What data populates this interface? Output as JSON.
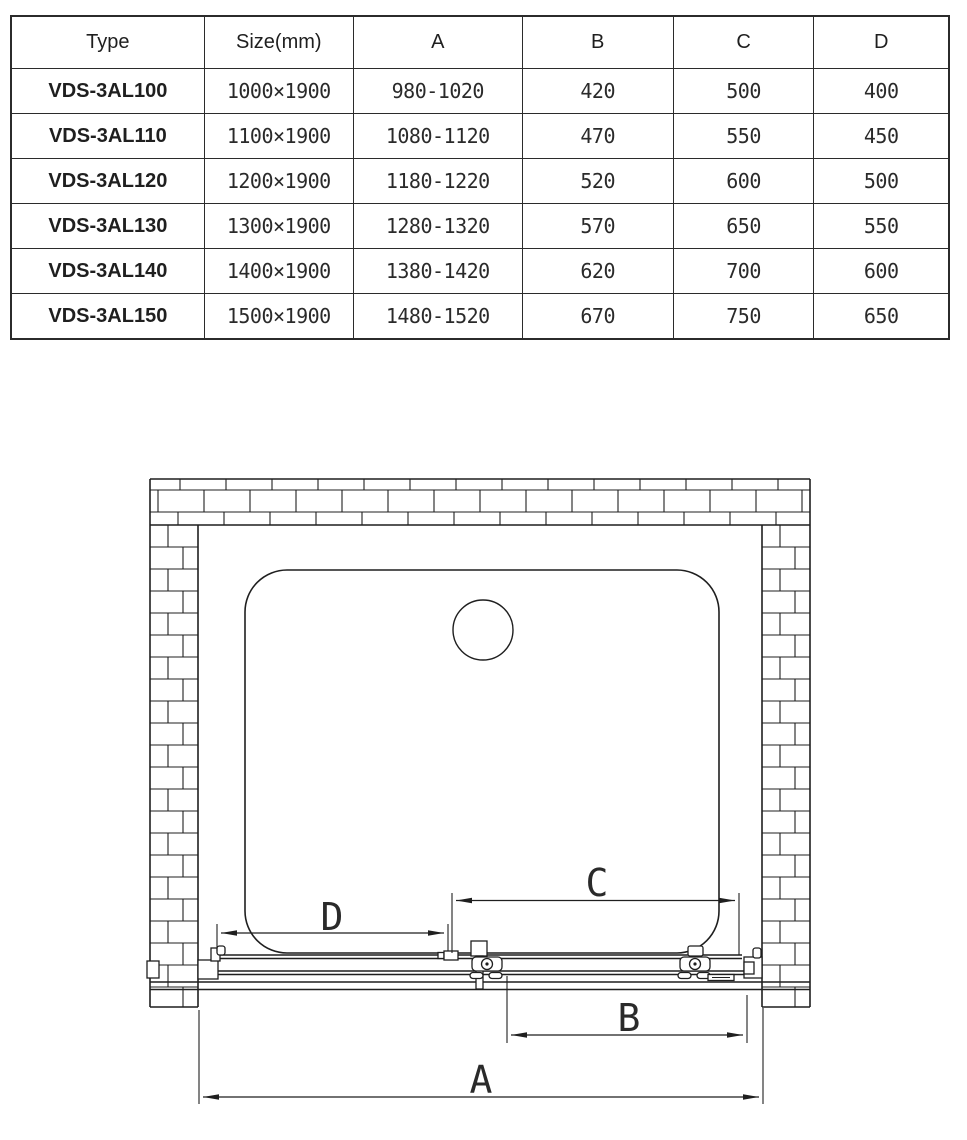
{
  "table": {
    "headers": [
      "Type",
      "Size(mm)",
      "A",
      "B",
      "C",
      "D"
    ],
    "rows": [
      [
        "VDS-3AL100",
        "1000×1900",
        "980-1020",
        "420",
        "500",
        "400"
      ],
      [
        "VDS-3AL110",
        "1100×1900",
        "1080-1120",
        "470",
        "550",
        "450"
      ],
      [
        "VDS-3AL120",
        "1200×1900",
        "1180-1220",
        "520",
        "600",
        "500"
      ],
      [
        "VDS-3AL130",
        "1300×1900",
        "1280-1320",
        "570",
        "650",
        "550"
      ],
      [
        "VDS-3AL140",
        "1400×1900",
        "1380-1420",
        "620",
        "700",
        "600"
      ],
      [
        "VDS-3AL150",
        "1500×1900",
        "1480-1520",
        "670",
        "750",
        "650"
      ]
    ]
  },
  "diagram": {
    "dim_labels": {
      "a": "A",
      "b": "B",
      "c": "C",
      "d": "D"
    }
  },
  "colors": {
    "line": "#1f1f1f",
    "background": "#ffffff"
  }
}
